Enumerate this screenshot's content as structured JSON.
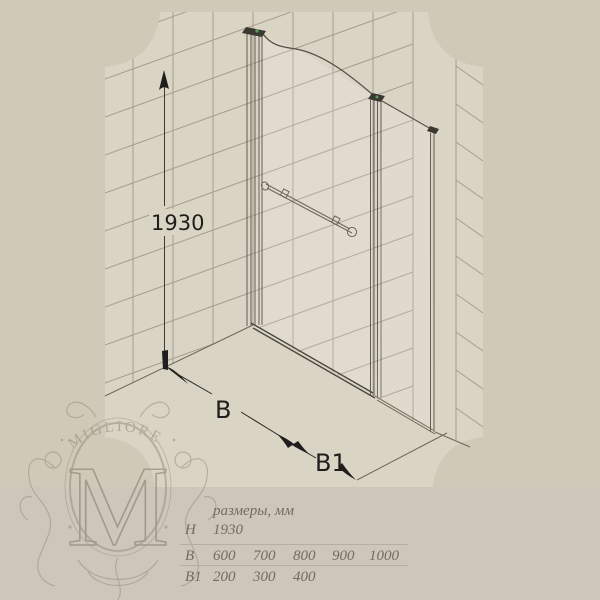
{
  "drawing": {
    "height_dim": "1930",
    "width_dim": "B",
    "side_dim": "B1"
  },
  "logo": {
    "brand": "MIGLIORE",
    "monogram": "M"
  },
  "table": {
    "title": "размеры, мм",
    "rows": [
      {
        "param": "H",
        "values": [
          "1930",
          "",
          "",
          "",
          ""
        ]
      },
      {
        "param": "B",
        "values": [
          "600",
          "700",
          "800",
          "900",
          "1000"
        ]
      },
      {
        "param": "B1",
        "values": [
          "200",
          "300",
          "400",
          "",
          ""
        ]
      }
    ]
  },
  "colors": {
    "background": "#cfc9b8",
    "panel": "#dad4c4",
    "bottom_band": "#ccc7ba",
    "tile_line": "#a69e8e",
    "profile_line": "#4c473f",
    "dimension_text": "#1f1e1c",
    "table_text": "#756c5d",
    "logo_tone": "#938c7c",
    "accent_green": "#55a055"
  }
}
